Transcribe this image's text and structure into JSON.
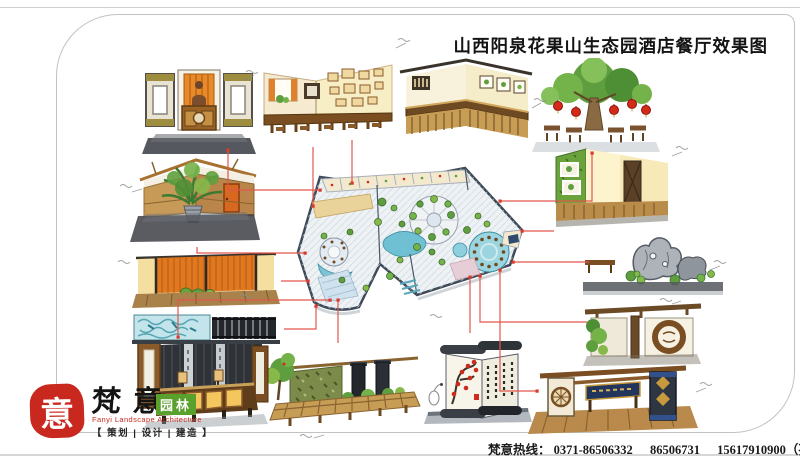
{
  "page": {
    "title": "山西阳泉花果山生态园酒店餐厅效果图"
  },
  "footer": {
    "hotline_label": "梵意热线：",
    "phones": [
      "0371-86506332",
      "86506731",
      "15617910900（孙）"
    ]
  },
  "logo": {
    "seal_char": "意",
    "brand_chars": [
      "梵",
      "意"
    ],
    "brand_suffix": "园林",
    "english": "Fanyi Landscape Architecture",
    "services": "【 策划 | 设计 | 建造 】"
  },
  "plan": {
    "id": "restaurant-master-plan",
    "view": "axonometric-colored-floor-plan"
  },
  "sketches": [
    {
      "id": "reception-desk",
      "note": "reception counter with statue niche"
    },
    {
      "id": "photo-wall-dining",
      "note": "dining corner, picture frames, curtained window"
    },
    {
      "id": "bar-counter-corner",
      "note": "corner counter with framed art and slat base"
    },
    {
      "id": "lantern-tree-dining",
      "note": "tables under tree hung with red lanterns"
    },
    {
      "id": "green-wall-dining",
      "note": "moss wall with framed openings, timber door"
    },
    {
      "id": "rockery-feature",
      "note": "taihu stone rockery with planting"
    },
    {
      "id": "moon-ring-wall",
      "note": "timber wall, circular medallion, climbing plants"
    },
    {
      "id": "entrance-gateway",
      "note": "entry gate with signboard and patterned pylons"
    },
    {
      "id": "scroll-screen",
      "note": "scroll screen with plum blossom and calligraphy"
    },
    {
      "id": "planter-screen-wall",
      "note": "landscape wall with dark pillars and shrubs"
    },
    {
      "id": "lit-bar-front",
      "note": "back-lit bar against timber slat wall"
    },
    {
      "id": "potted-plant-corner",
      "note": "corner with fan palm and orange door"
    },
    {
      "id": "orange-slat-screen",
      "note": "orange timber slat screen elevation"
    },
    {
      "id": "water-pattern-panel",
      "note": "blue water-pattern panel with dark lattice"
    }
  ],
  "colors": {
    "accent_red": "#d93a2c",
    "seal_red": "#c8281e",
    "brand_green": "#5aa02c",
    "frame_gray": "#c2c2c2"
  }
}
